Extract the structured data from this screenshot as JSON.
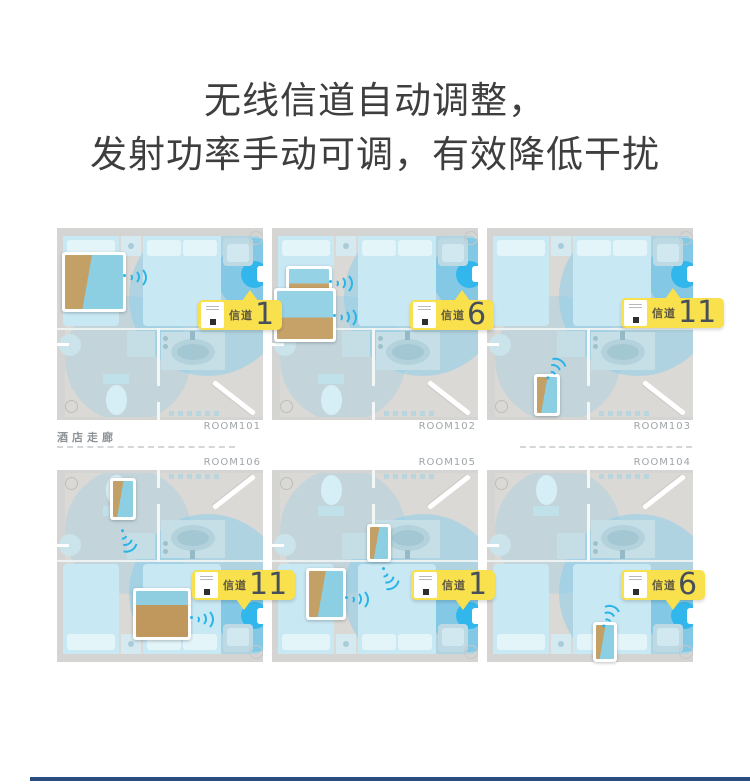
{
  "title": {
    "line1": "无线信道自动调整，",
    "line2": "发射功率手动可调，有效降低干扰"
  },
  "corridor_label": "酒店走廊",
  "channel_word": "信道",
  "colors": {
    "badge_yellow": "#f8e14d",
    "wifi_blue": "#29b4e8",
    "accent_bar": "#2a4c7e",
    "floor_gray": "#dbd9d5",
    "coverage_blue": "rgba(140,206,235,0.55)"
  },
  "rooms": [
    {
      "label": "ROOM101",
      "channel": "1",
      "row": 0,
      "col": 0,
      "badge": {
        "x": 141,
        "y": 72
      },
      "devices": [
        {
          "kind": "tv",
          "x": 5,
          "y": 24,
          "w": 58,
          "h": 54,
          "art": "cliff",
          "wifi": {
            "x": 67,
            "y": 38,
            "rot": 0
          }
        }
      ]
    },
    {
      "label": "ROOM102",
      "channel": "6",
      "row": 0,
      "col": 1,
      "badge": {
        "x": 138,
        "y": 72
      },
      "devices": [
        {
          "kind": "phone",
          "x": 14,
          "y": 38,
          "w": 40,
          "h": 26,
          "art": "beach",
          "wifi": {
            "x": 58,
            "y": 44,
            "rot": 0
          }
        },
        {
          "kind": "tv",
          "x": 2,
          "y": 60,
          "w": 56,
          "h": 48,
          "art": "beach",
          "wifi": {
            "x": 62,
            "y": 78,
            "rot": 0
          }
        }
      ]
    },
    {
      "label": "ROOM103",
      "channel": "11",
      "row": 0,
      "col": 2,
      "badge": {
        "x": 134,
        "y": 70
      },
      "devices": [
        {
          "kind": "phone",
          "x": 47,
          "y": 146,
          "w": 20,
          "h": 36,
          "art": "cliff",
          "wifi": {
            "x": 62,
            "y": 140,
            "rot": -60
          }
        }
      ]
    },
    {
      "label": "ROOM106",
      "channel": "11",
      "row": 1,
      "col": 0,
      "badge": {
        "x": 135,
        "y": 100
      },
      "devices": [
        {
          "kind": "phone",
          "x": 53,
          "y": 8,
          "w": 20,
          "h": 36,
          "art": "cliff",
          "wifi": {
            "x": 64,
            "y": 50,
            "rot": 60
          }
        },
        {
          "kind": "tv",
          "x": 76,
          "y": 118,
          "w": 52,
          "h": 46,
          "art": "desert",
          "wifi": {
            "x": 134,
            "y": 138,
            "rot": 0
          }
        }
      ]
    },
    {
      "label": "ROOM105",
      "channel": "1",
      "row": 1,
      "col": 1,
      "badge": {
        "x": 139,
        "y": 100
      },
      "devices": [
        {
          "kind": "phone",
          "x": 95,
          "y": 54,
          "w": 18,
          "h": 32,
          "art": "cliff",
          "wifi": {
            "x": 110,
            "y": 88,
            "rot": 55
          }
        },
        {
          "kind": "tv",
          "x": 34,
          "y": 98,
          "w": 34,
          "h": 46,
          "art": "cliff",
          "wifi": {
            "x": 74,
            "y": 118,
            "rot": 0
          }
        }
      ]
    },
    {
      "label": "ROOM104",
      "channel": "6",
      "row": 1,
      "col": 2,
      "badge": {
        "x": 134,
        "y": 100
      },
      "devices": [
        {
          "kind": "phone",
          "x": 106,
          "y": 152,
          "w": 18,
          "h": 34,
          "art": "cliff",
          "wifi": {
            "x": 118,
            "y": 146,
            "rot": -70
          }
        }
      ]
    }
  ]
}
